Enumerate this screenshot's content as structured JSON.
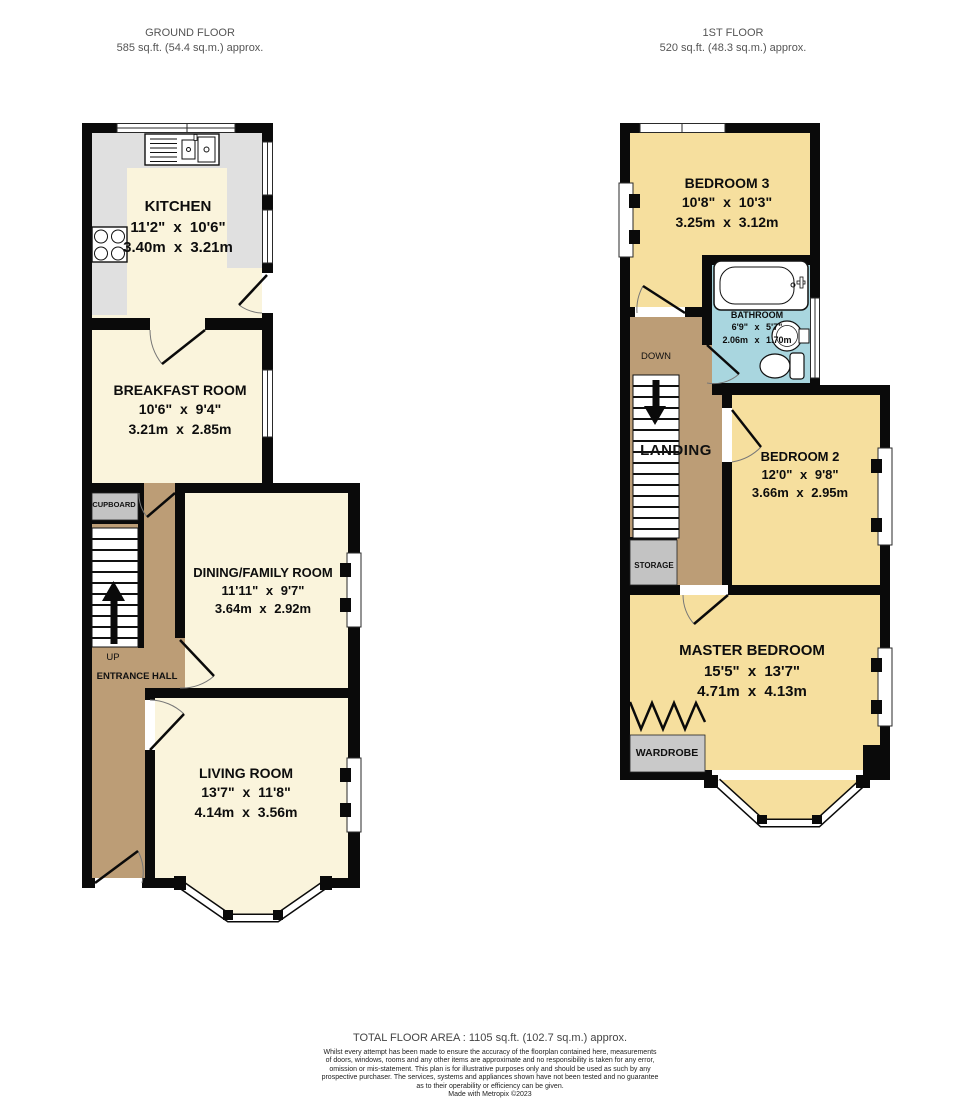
{
  "ground_floor": {
    "title": "GROUND FLOOR",
    "area": "585 sq.ft. (54.4 sq.m.) approx.",
    "rooms": {
      "kitchen": {
        "name": "KITCHEN",
        "imperial": "11'2\" x 10'6\"",
        "metric": "3.40m x 3.21m"
      },
      "breakfast": {
        "name": "BREAKFAST ROOM",
        "imperial": "10'6\" x 9'4\"",
        "metric": "3.21m x 2.85m"
      },
      "dining": {
        "name": "DINING/FAMILY ROOM",
        "imperial": "11'11\" x 9'7\"",
        "metric": "3.64m x 2.92m"
      },
      "living": {
        "name": "LIVING ROOM",
        "imperial": "13'7\" x 11'8\"",
        "metric": "4.14m x 3.56m"
      }
    },
    "labels": {
      "cupboard": "CUPBOARD",
      "up": "UP",
      "entrance_hall": "ENTRANCE HALL"
    }
  },
  "first_floor": {
    "title": "1ST FLOOR",
    "area": "520 sq.ft. (48.3 sq.m.) approx.",
    "rooms": {
      "bedroom3": {
        "name": "BEDROOM 3",
        "imperial": "10'8\" x 10'3\"",
        "metric": "3.25m x 3.12m"
      },
      "bathroom": {
        "name": "BATHROOM",
        "imperial": "6'9\" x 5'7\"",
        "metric": "2.06m x 1.70m"
      },
      "bedroom2": {
        "name": "BEDROOM 2",
        "imperial": "12'0\" x 9'8\"",
        "metric": "3.66m x 2.95m"
      },
      "master": {
        "name": "MASTER BEDROOM",
        "imperial": "15'5\" x 13'7\"",
        "metric": "4.71m x 4.13m"
      }
    },
    "labels": {
      "down": "DOWN",
      "landing": "LANDING",
      "storage": "STORAGE",
      "wardrobe": "WARDROBE"
    }
  },
  "footer": {
    "total_area": "TOTAL FLOOR AREA : 1105 sq.ft. (102.7 sq.m.) approx.",
    "disclaimer_lines": [
      "Whilst every attempt has been made to ensure the accuracy of the floorplan contained here, measurements",
      "of doors, windows, rooms and any other items are approximate and no responsibility is taken for any error,",
      "omission or mis-statement. This plan is for illustrative purposes only and should be used as such by any",
      "prospective purchaser. The services, systems and appliances shown have not been tested and no guarantee",
      "as to their operability or efficiency can be given."
    ],
    "credit": "Made with Metropix ©2023"
  },
  "colors": {
    "wall": "#0A0A0A",
    "room_cream": "#FAF4DC",
    "hall_tan": "#BC9D76",
    "bedroom_yellow": "#F6DF9E",
    "bathroom_blue": "#A9D6DF",
    "counter_gray": "#E0E0E0",
    "closet_gray": "#C3C3C3"
  }
}
